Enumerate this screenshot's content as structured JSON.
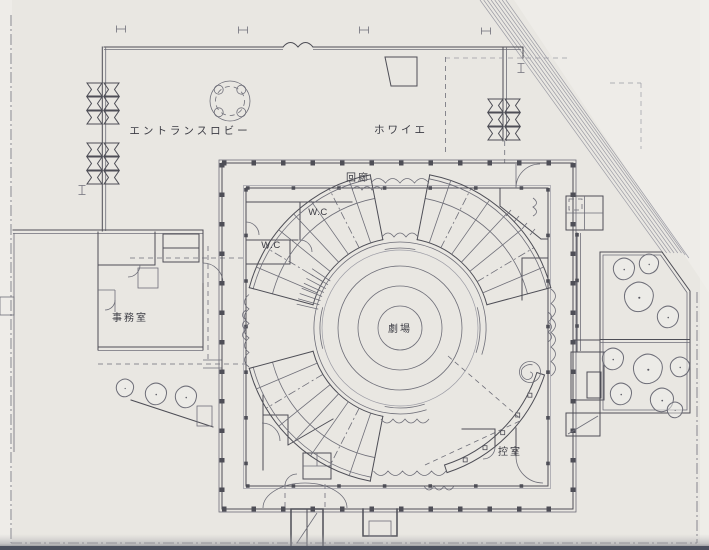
{
  "document": {
    "type": "architectural floor plan",
    "building": "circular theater"
  },
  "plan": {
    "labels": {
      "entrance_lobby": "エントランスロビー",
      "foyer": "ホワイエ",
      "cloister": "回廊",
      "wc_upper": "W.C",
      "wc_lower": "W.C",
      "office": "事務室",
      "theater": "劇場",
      "green_room": "控室"
    },
    "colors": {
      "paper": "#e9e7e2",
      "paper-light": "#f2f1ed",
      "ink": "#3c3c44",
      "line": "#4e4e56",
      "line-soft": "#6e6e78",
      "line-faint": "#9b9ba4",
      "band": "#bcbcc4",
      "edge-dark": "#4b505e"
    }
  }
}
